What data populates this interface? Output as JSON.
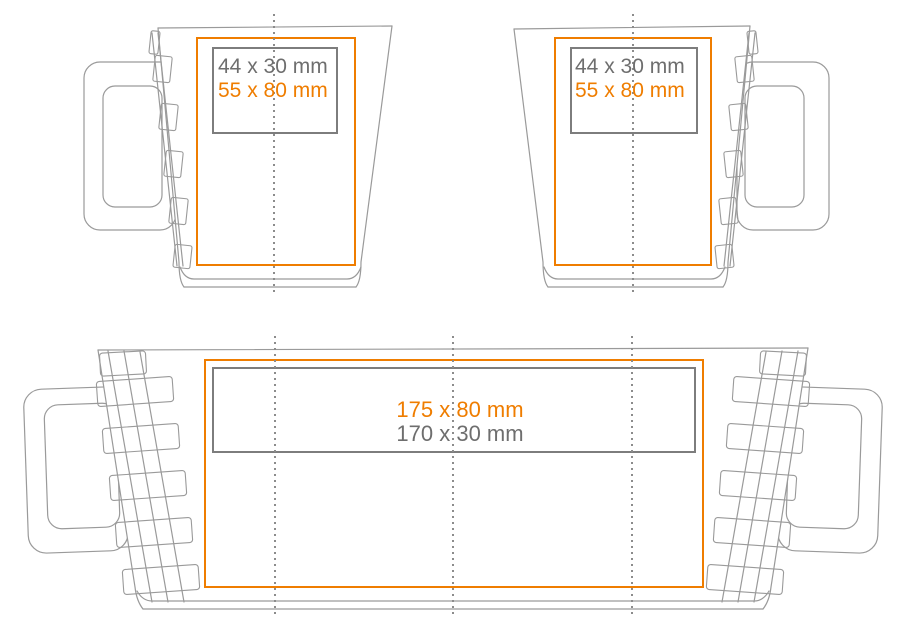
{
  "colors": {
    "accent-orange": "#ef7d00",
    "dim-text-gray": "#6e6e6e",
    "label-box-gray": "#7d7d7d",
    "outline-gray": "#9a9a9a",
    "centerline-gray": "#8c8c8c"
  },
  "front_view_left_handle": {
    "label_gray": "44 x 30 mm",
    "label_orange": "55 x 80 mm"
  },
  "front_view_right_handle": {
    "label_gray": "44 x 30 mm",
    "label_orange": "55 x 80 mm"
  },
  "unrolled_view": {
    "label_orange": "175 x 80 mm",
    "label_gray": "170 x 30 mm"
  }
}
